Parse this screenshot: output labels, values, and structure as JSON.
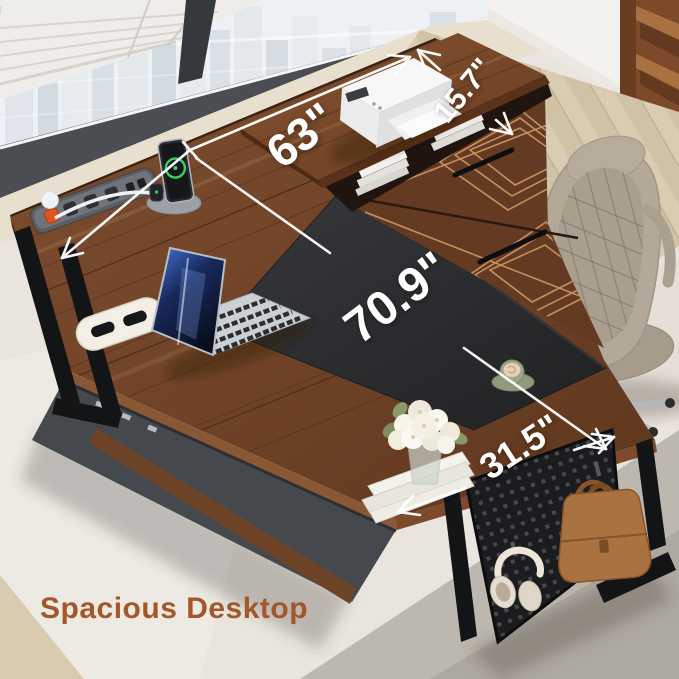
{
  "caption": "Spacious Desktop",
  "dimensions": {
    "desk_length": "63\"",
    "hutch_depth": "15.7\"",
    "total_length": "70.9\"",
    "desk_depth": "31.5\""
  },
  "palette": {
    "desk_wood": "#74452b",
    "desk_frame_black": "#17181a",
    "desk_mat": "#2e3032",
    "drawer_inlay_copper": "#d8a06a",
    "caption_color": "#a4572a",
    "dimension_color": "#ffffff",
    "rug": "#e9e5de",
    "floor_wood": "#d6c8ac",
    "wall": "#e8dfce",
    "chair_leather": "#b3a899",
    "briefcase_leather": "#aa7240",
    "charge_ring_green": "#3ad15f",
    "power_switch_orange": "#e0551f"
  },
  "objects_visible": [
    "city-view window with blinds",
    "white multifunction printer",
    "open laptop",
    "smartphone on charging dock",
    "smartwatch",
    "built-in power strip",
    "cable grommet",
    "white flower bouquet in vase",
    "stack of white books",
    "green coffee cup on saucer",
    "executive office chair",
    "headphones on hook",
    "leather briefcase on hook",
    "mesh pegboard side panel",
    "drawer cabinet with copper inlay",
    "black desk pad",
    "wooden bookshelf",
    "herringbone wood floor",
    "area rug"
  ]
}
